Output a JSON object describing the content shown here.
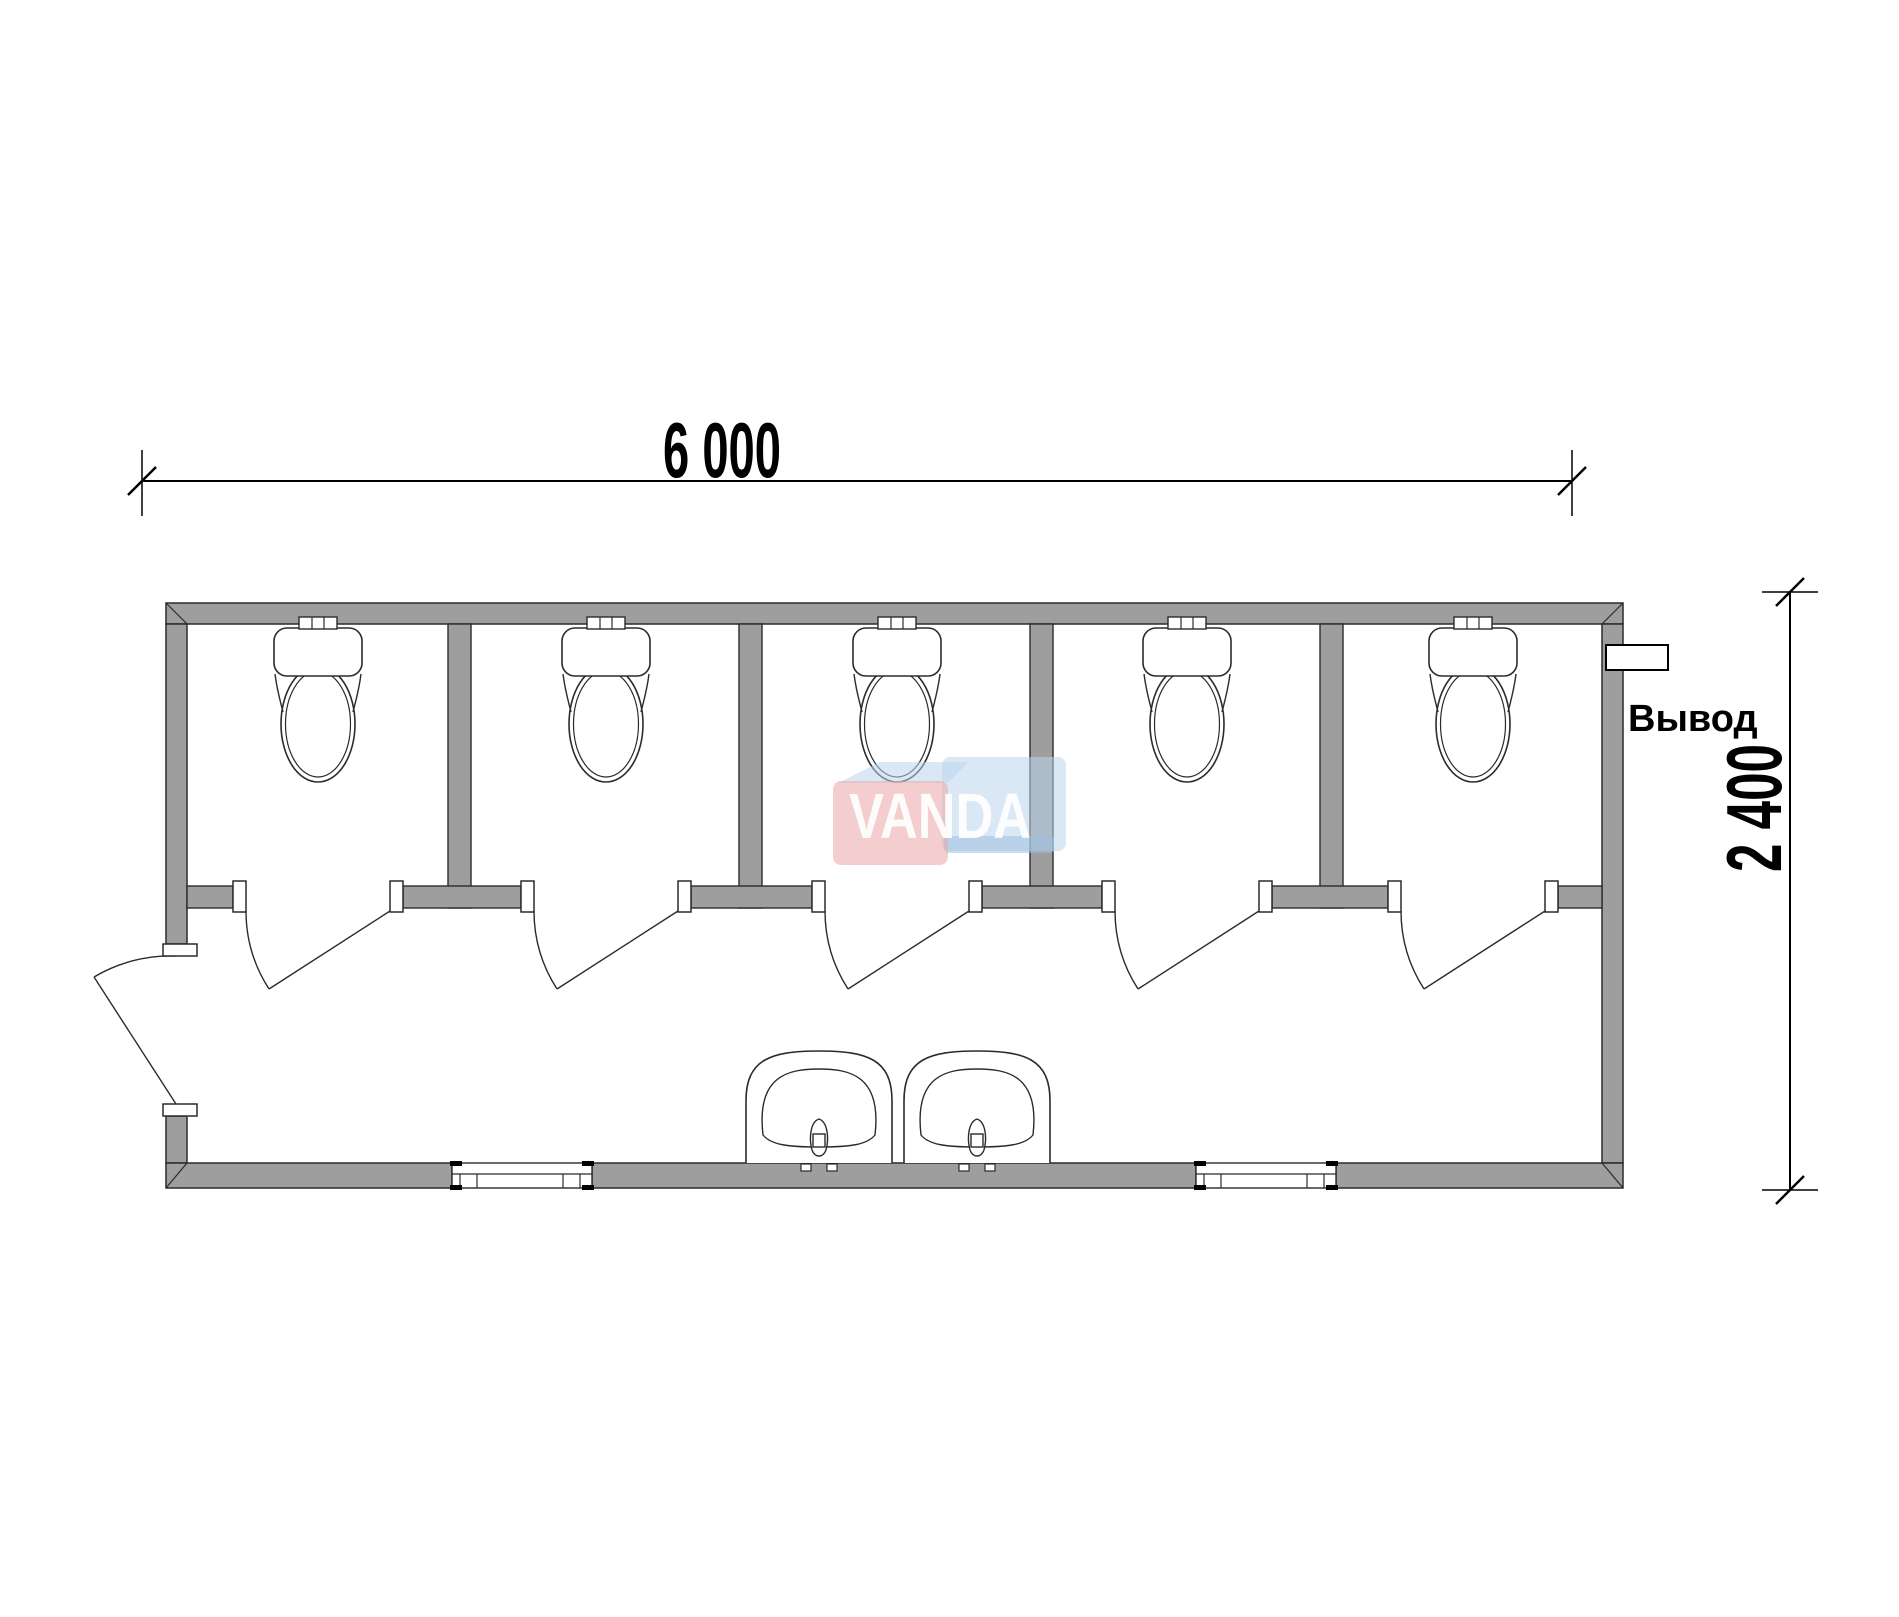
{
  "labels": {
    "width_dimension": "6 000",
    "height_dimension": "2 400",
    "outlet": "Вывод",
    "watermark": "VANDA"
  },
  "plan": {
    "toilet_stalls": 5,
    "toilets": 5,
    "stall_doors": 5,
    "entrance_doors": 1,
    "sinks": 2,
    "windows": 2,
    "outlets": 1
  },
  "colors": {
    "background": "#ffffff",
    "wall_fill": "#9e9e9e",
    "line": "#2b2b2b",
    "watermark_red": "#eba6a6",
    "watermark_blue": "#bcd6ec",
    "watermark_blue_dark": "#9fc0de",
    "watermark_text": "#ffffff"
  }
}
